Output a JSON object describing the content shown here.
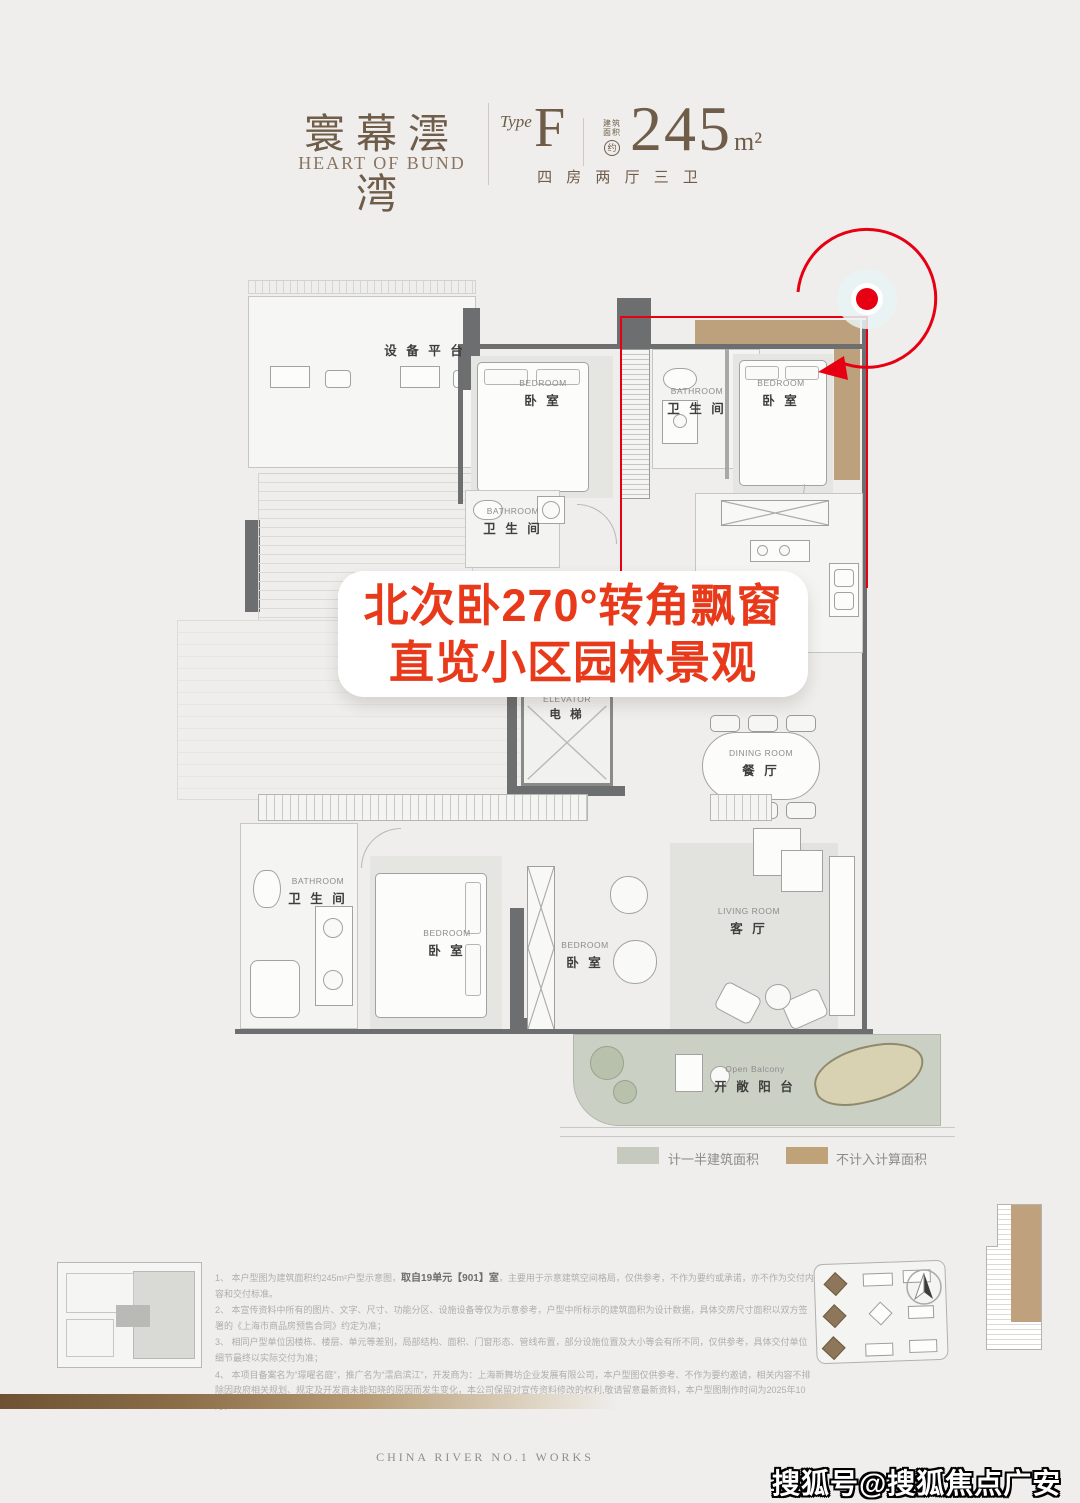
{
  "page": {
    "bg_color": "#efeeec",
    "brand_brown": "#6f5c49",
    "callout_red": "#e8391a",
    "annotation_red": "#e60012"
  },
  "header": {
    "brand_cn": "寰幕澐湾",
    "brand_en": "HEART OF BUND",
    "type_label": "Type",
    "type_value": "F",
    "area_prefix_line1": "建筑",
    "area_prefix_line2": "面积",
    "area_prefix_circle": "约",
    "area_value": "245",
    "area_unit": "m²",
    "layout_desc": "四 房 两 厅 三 卫"
  },
  "callout": {
    "line1": "北次卧270°转角飘窗",
    "line2": "直览小区园林景观"
  },
  "rooms": {
    "equipment": {
      "cn": "设 备 平 台"
    },
    "bedroom_nw": {
      "en": "BEDROOM",
      "cn": "卧 室"
    },
    "bathroom_top": {
      "en": "BATHROOM",
      "cn": "卫 生 间"
    },
    "bedroom_ne": {
      "en": "BEDROOM",
      "cn": "卧 室"
    },
    "bathroom_mid": {
      "en": "BATHROOM",
      "cn": "卫 生 间"
    },
    "elevator": {
      "en": "ELEVATOR",
      "cn": "电 梯"
    },
    "dining": {
      "en": "DINING ROOM",
      "cn": "餐 厅"
    },
    "bathroom_master": {
      "en": "BATHROOM",
      "cn": "卫 生 间"
    },
    "bedroom_master": {
      "en": "BEDROOM",
      "cn": "卧 室"
    },
    "bedroom_mid": {
      "en": "BEDROOM",
      "cn": "卧 室"
    },
    "living": {
      "en": "LIVING ROOM",
      "cn": "客 厅"
    },
    "balcony": {
      "en": "Open Balcony",
      "cn": "开 敞 阳 台"
    }
  },
  "legend": {
    "half_label": "计一半建筑面积",
    "half_color": "#c6c9be",
    "excluded_label": "不计入计算面积",
    "excluded_color": "#c0a278"
  },
  "disclaimer": {
    "l1_pre": "1、 本户型图为建筑面积约245m²户型示意图，",
    "l1_bold": "取自19单元【901】室",
    "l1_post": "，主要用于示意建筑空间格局，仅供参考，不作为要约或承诺，亦不作为交付内容和交付标准。",
    "l2": "2、 本宣传资料中所有的图片、文字、尺寸、功能分区、设施设备等仅为示意参考，户型中所标示的建筑面积为设计数据，具体交房尺寸面积以双方签署的《上海市商品房预售合同》约定为准；",
    "l3": "3、 相同户型单位因楼栋、楼层、单元等差别，局部结构、面积、门窗形态、管线布置，部分设施位置及大小等会有所不同，仅供参考，具体交付单位细节最终以实际交付为准；",
    "l4": "4、 本项目备案名为“璟曜名庭”，推广名为“澐启滨江”，开发商为：上海新舞坊企业发展有限公司，本户型图仅供参考、不作为要约邀请，相关内容不排除因政府相关规划、规定及开发商未能知晓的原因而发生变化，本公司保留对宣传资料修改的权利,敬请留意最新资料，本户型图制作时间为2025年10月。"
  },
  "footer": {
    "tagline": "CHINA RIVER NO.1 WORKS",
    "watermark": "搜狐号@搜狐焦点广安站"
  }
}
